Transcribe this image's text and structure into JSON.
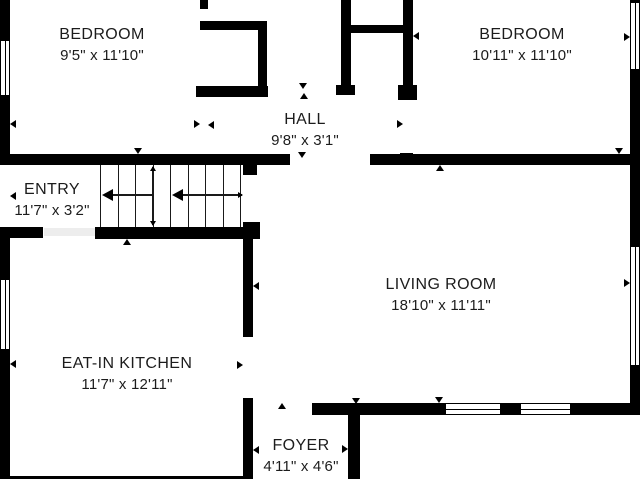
{
  "plan": {
    "background_color": "#ffffff",
    "wall_color": "#000000",
    "text_color": "#1c1c1c",
    "rooms": [
      {
        "id": "bedroom-left",
        "name": "BEDROOM",
        "dims": "9'5\" x 11'10\"",
        "cx": 102,
        "cy": 45
      },
      {
        "id": "bedroom-right",
        "name": "BEDROOM",
        "dims": "10'11\" x 11'10\"",
        "cx": 522,
        "cy": 45
      },
      {
        "id": "hall",
        "name": "HALL",
        "dims": "9'8\" x 3'1\"",
        "cx": 305,
        "cy": 130
      },
      {
        "id": "entry",
        "name": "ENTRY",
        "dims": "11'7\" x 3'2\"",
        "cx": 52,
        "cy": 200
      },
      {
        "id": "living-room",
        "name": "LIVING ROOM",
        "dims": "18'10\" x 11'11\"",
        "cx": 441,
        "cy": 295
      },
      {
        "id": "eat-in-kitchen",
        "name": "EAT-IN KITCHEN",
        "dims": "11'7\" x 12'11\"",
        "cx": 127,
        "cy": 374
      },
      {
        "id": "foyer",
        "name": "FOYER",
        "dims": "4'11\" x 4'6\"",
        "cx": 301,
        "cy": 456
      }
    ],
    "walls": [
      [
        0,
        0,
        10,
        38
      ],
      [
        0,
        98,
        10,
        59
      ],
      [
        0,
        227,
        10,
        50
      ],
      [
        0,
        352,
        10,
        127
      ],
      [
        200,
        0,
        8,
        9
      ],
      [
        200,
        21,
        67,
        9
      ],
      [
        258,
        21,
        9,
        76
      ],
      [
        196,
        86,
        72,
        11
      ],
      [
        341,
        0,
        10,
        85
      ],
      [
        336,
        85,
        19,
        10
      ],
      [
        351,
        25,
        54,
        8
      ],
      [
        403,
        0,
        10,
        85
      ],
      [
        398,
        85,
        19,
        15
      ],
      [
        0,
        154,
        290,
        11
      ],
      [
        370,
        154,
        270,
        11
      ],
      [
        400,
        153,
        13,
        12
      ],
      [
        0,
        227,
        43,
        11
      ],
      [
        95,
        227,
        165,
        12
      ],
      [
        243,
        162,
        14,
        13
      ],
      [
        243,
        222,
        17,
        17
      ],
      [
        243,
        239,
        10,
        98
      ],
      [
        243,
        398,
        10,
        81
      ],
      [
        312,
        403,
        131,
        12
      ],
      [
        503,
        403,
        15,
        12
      ],
      [
        573,
        403,
        67,
        12
      ],
      [
        348,
        405,
        12,
        74
      ],
      [
        630,
        72,
        10,
        172
      ],
      [
        630,
        368,
        10,
        47
      ],
      [
        0,
        476,
        253,
        3
      ]
    ],
    "windows": [
      [
        0,
        38,
        10,
        60
      ],
      [
        0,
        277,
        10,
        75
      ],
      [
        630,
        0,
        10,
        72
      ],
      [
        630,
        244,
        10,
        124
      ],
      [
        443,
        403,
        60,
        12
      ],
      [
        518,
        403,
        55,
        12
      ]
    ],
    "door_shades": [
      [
        44,
        228,
        51,
        8
      ]
    ],
    "stair_treads": [
      [
        100,
        165,
        1.3,
        62
      ],
      [
        117.5,
        165,
        1.3,
        62
      ],
      [
        135,
        165,
        1.3,
        62
      ],
      [
        152.5,
        165,
        1.3,
        62
      ],
      [
        170,
        165,
        1.3,
        62
      ],
      [
        187.5,
        165,
        1.3,
        62
      ],
      [
        205,
        165,
        1.3,
        62
      ],
      [
        222.5,
        165,
        1.3,
        62
      ],
      [
        240,
        165,
        1.3,
        62
      ]
    ],
    "stair_arrow_lines": [
      [
        104,
        194.4,
        49,
        1.4
      ],
      [
        174,
        194.4,
        68,
        1.4
      ],
      [
        152.4,
        167,
        1.4,
        58
      ]
    ],
    "tri_sizes": {
      "m": [
        6,
        4.5
      ],
      "b": [
        11,
        6
      ],
      "t": [
        5,
        3.5
      ]
    },
    "markers": [
      [
        "left",
        10,
        124,
        "m"
      ],
      [
        "right",
        200,
        124,
        "m"
      ],
      [
        "left",
        208,
        125,
        "m"
      ],
      [
        "right",
        403,
        124,
        "m"
      ],
      [
        "left",
        413,
        36,
        "m"
      ],
      [
        "right",
        630,
        37,
        "m"
      ],
      [
        "down",
        138,
        154,
        "m"
      ],
      [
        "up",
        127,
        239,
        "m"
      ],
      [
        "down",
        303,
        89,
        "m"
      ],
      [
        "up",
        304,
        93,
        "m"
      ],
      [
        "down",
        302,
        158,
        "m"
      ],
      [
        "up",
        440,
        165,
        "m"
      ],
      [
        "down",
        439,
        403,
        "m"
      ],
      [
        "up",
        282,
        403,
        "m"
      ],
      [
        "down",
        356,
        404,
        "m"
      ],
      [
        "left",
        253,
        450,
        "m"
      ],
      [
        "right",
        348,
        449,
        "m"
      ],
      [
        "left",
        10,
        364,
        "m"
      ],
      [
        "right",
        243,
        365,
        "m"
      ],
      [
        "left",
        10,
        196,
        "m"
      ],
      [
        "left",
        253,
        286,
        "m"
      ],
      [
        "right",
        630,
        283,
        "m"
      ],
      [
        "down",
        619,
        154,
        "m"
      ],
      [
        "left",
        102,
        195,
        "b"
      ],
      [
        "left",
        172,
        195,
        "b"
      ],
      [
        "right",
        243,
        195,
        "t"
      ],
      [
        "up",
        153,
        166,
        "t"
      ],
      [
        "down",
        153,
        226,
        "t"
      ]
    ]
  }
}
